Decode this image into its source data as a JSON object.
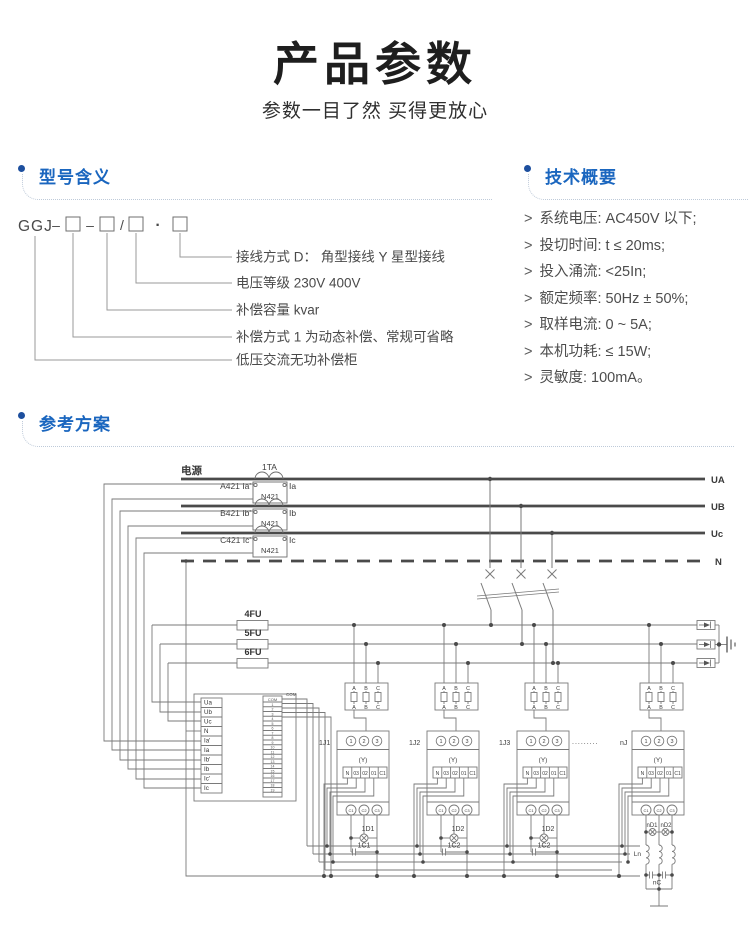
{
  "page": {
    "title": "产品参数",
    "subtitle": "参数一目了然 买得更放心"
  },
  "model_section": {
    "header": "型号含义",
    "code": {
      "name": "GGJ",
      "sep1": "–",
      "sep2": "–",
      "sep3": "/",
      "sep4": "·"
    },
    "labels": [
      "接线方式 D： 角型接线 Y 星型接线",
      "电压等级 230V 400V",
      "补偿容量 kvar",
      "补偿方式 1 为动态补偿、常规可省略",
      "低压交流无功补偿柜"
    ]
  },
  "tech_section": {
    "header": "技术概要",
    "marker": ">",
    "items": [
      "系统电压: AC450V 以下;",
      "投切时间: t ≤ 20ms;",
      "投入涌流: <25In;",
      "额定频率: 50Hz ± 50%;",
      "取样电流: 0 ~ 5A;",
      "本机功耗: ≤ 15W;",
      "灵敏度: 100mA。"
    ]
  },
  "reference_section": {
    "header": "参考方案",
    "diagram": {
      "power": "电源",
      "ct_label": "1TA",
      "rows": [
        {
          "tag": "A421 Ia'",
          "mid": "N421",
          "out": "Ia",
          "bus": "UA"
        },
        {
          "tag": "B421 Ib'",
          "mid": "N421",
          "out": "Ib",
          "bus": "UB"
        },
        {
          "tag": "C421 Ic'",
          "mid": "N421",
          "out": "Ic",
          "bus": "Uc"
        }
      ],
      "neutral": "N",
      "fuses": [
        "4FU",
        "5FU",
        "6FU"
      ],
      "controller": {
        "terminals": [
          "Ua",
          "Ub",
          "Uc",
          "N",
          "Ia'",
          "Ia",
          "Ib'",
          "Ib",
          "Ic'",
          "Ic"
        ],
        "strip_header": "COM",
        "strip_note": "COM",
        "strip_numbers": [
          "1",
          "2",
          "3",
          "4",
          "5",
          "6",
          "7",
          "8",
          "9",
          "10",
          "11",
          "12",
          "13",
          "14",
          "15",
          "16",
          "17",
          "18",
          "19"
        ]
      },
      "module_common": {
        "phases": [
          "A",
          "B",
          "C"
        ],
        "ports": [
          "1",
          "2",
          "3"
        ],
        "wye": "(Y)",
        "strip": [
          "N",
          "03",
          "02",
          "01",
          "C1"
        ],
        "outputs": [
          "C1",
          "C2",
          "C3"
        ]
      },
      "modules": [
        {
          "id": "1J1",
          "lamp": "1D1",
          "cap": "1C1"
        },
        {
          "id": "1J2",
          "lamp": "1D2",
          "cap": "1C2"
        },
        {
          "id": "1J3",
          "lamp": "1D2",
          "cap": "1C2"
        },
        {
          "id": "nJ",
          "lamp1": "nD1",
          "lamp2": "nD2",
          "inductor": "Ln",
          "cap": "nC",
          "ellipsis": "........."
        }
      ]
    }
  }
}
